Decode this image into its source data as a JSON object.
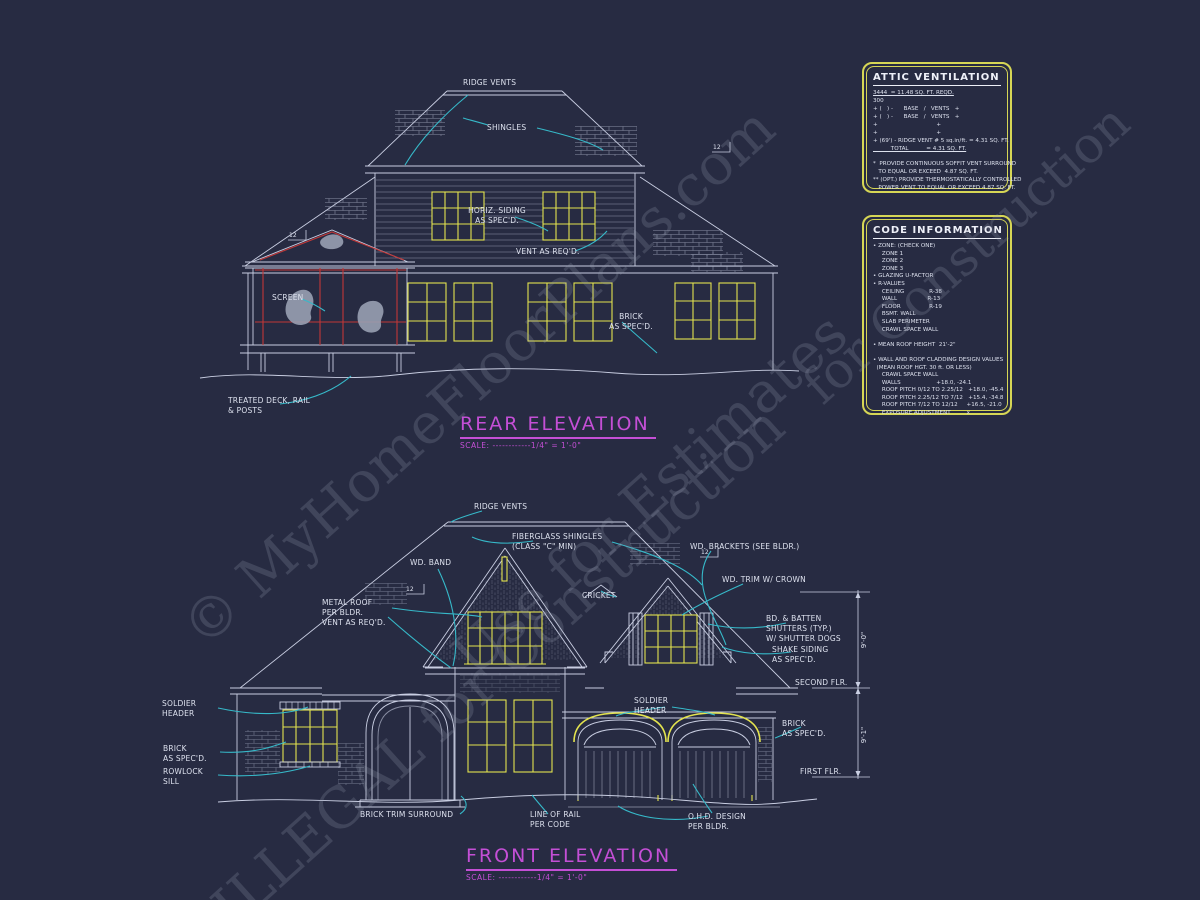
{
  "watermarks": {
    "line1": "© MyHomeFloorPlans.com",
    "line2": "Use for Estimates",
    "line3": "ILLEGAL for Construction",
    "line4": "for Construction"
  },
  "attic_box": {
    "title": "ATTIC VENTILATION",
    "lines": [
      {
        "t": "3444  = 11.48 SQ. FT. REQD.",
        "u": true
      },
      {
        "t": "300"
      },
      {
        "t": "+ (   ) -      BASE   /   VENTS   +"
      },
      {
        "t": "+ (   ) -      BASE   /   VENTS   +"
      },
      {
        "t": "+                                 +"
      },
      {
        "t": "+                                 +"
      },
      {
        "t": "+ (69') - RIDGE VENT # 5 sq.in/ft. = 4.31 SQ. FT."
      },
      {
        "t": "          TOTAL          = 4.31 SQ. FT.",
        "u": true
      },
      {
        "t": " "
      },
      {
        "t": "*  PROVIDE CONTINUOUS SOFFIT VENT SURROUND"
      },
      {
        "t": "   TO EQUAL OR EXCEED  4.87 SQ. FT."
      },
      {
        "t": "** (OPT.) PROVIDE THERMOSTATICALLY CONTROLLED"
      },
      {
        "t": "   POWER VENT TO EQUAL OR EXCEED 4.87 SQ. FT."
      }
    ]
  },
  "code_box": {
    "title": "CODE INFORMATION",
    "lines": [
      {
        "t": "• ZONE: (CHECK ONE)"
      },
      {
        "t": "     ZONE 1"
      },
      {
        "t": "     ZONE 2"
      },
      {
        "t": "     ZONE 3"
      },
      {
        "t": "• GLAZING U-FACTOR"
      },
      {
        "t": "• R-VALUES"
      },
      {
        "t": "     CEILING              R-38"
      },
      {
        "t": "     WALL                 R-13"
      },
      {
        "t": "     FLOOR                R-19"
      },
      {
        "t": "     BSMT. WALL"
      },
      {
        "t": "     SLAB PERIMETER"
      },
      {
        "t": "     CRAWL SPACE WALL"
      },
      {
        "t": " "
      },
      {
        "t": "• MEAN ROOF HEIGHT  21'-2\""
      },
      {
        "t": " "
      },
      {
        "t": "• WALL AND ROOF CLADDING DESIGN VALUES"
      },
      {
        "t": "  (MEAN ROOF HGT. 30 ft. OR LESS)"
      },
      {
        "t": "     CRAWL SPACE WALL"
      },
      {
        "t": "     WALLS                    +18.0, -24.1"
      },
      {
        "t": "     ROOF PITCH 0/12 TO 2.25/12   +18.0, -45.4"
      },
      {
        "t": "     ROOF PITCH 2.25/12 TO 7/12   +15.4, -34.8"
      },
      {
        "t": "     ROOF PITCH 7/12 TO 12/12     +16.5, -21.0"
      },
      {
        "t": "     EXPOSURE ADJUSTMENT         x"
      }
    ]
  },
  "rear": {
    "title": "REAR ELEVATION",
    "scale": "SCALE: ------------1/4\" = 1'-0\"",
    "pitch": "12",
    "labels": {
      "ridge_vents": "RIDGE VENTS",
      "shingles": "SHINGLES",
      "horiz_siding": "HORIZ. SIDING\nAS SPEC'D.",
      "vent_reqd": "VENT AS REQ'D.",
      "screen": "SCREEN",
      "brick": "BRICK\nAS SPEC'D.",
      "deck": "TREATED DECK, RAIL\n& POSTS"
    }
  },
  "front": {
    "title": "FRONT ELEVATION",
    "scale": "SCALE: ------------1/4\" = 1'-0\"",
    "pitch": "12",
    "dims": [
      "9'-0\"",
      "9'-1\""
    ],
    "labels": {
      "ridge_vents": "RIDGE VENTS",
      "fiberglass": "FIBERGLASS SHINGLES\n(CLASS \"C\" MIN)",
      "wd_band": "WD. BAND",
      "wd_brackets": "WD. BRACKETS (SEE BLDR.)",
      "wd_trim": "WD. TRIM W/ CROWN",
      "cricket": "CRICKET",
      "metal_roof": "METAL ROOF\nPER BLDR.\nVENT AS REQ'D.",
      "bd_batten": "BD. & BATTEN\nSHUTTERS (TYP.)\nW/ SHUTTER DOGS",
      "shake": "SHAKE SIDING\nAS SPEC'D.",
      "second_flr": "SECOND FLR.",
      "soldier_left": "SOLDIER\nHEADER",
      "soldier_mid": "SOLDIER\nHEADER",
      "brick_right": "BRICK\nAS SPEC'D.",
      "brick_left": "BRICK\nAS SPEC'D.",
      "rowlock": "ROWLOCK\nSILL",
      "first_flr": "FIRST FLR.",
      "brick_trim": "BRICK TRIM SURROUND",
      "line_of_rail": "LINE OF RAIL\nPER CODE",
      "ohd": "O.H.D. DESIGN\nPER BLDR."
    }
  }
}
